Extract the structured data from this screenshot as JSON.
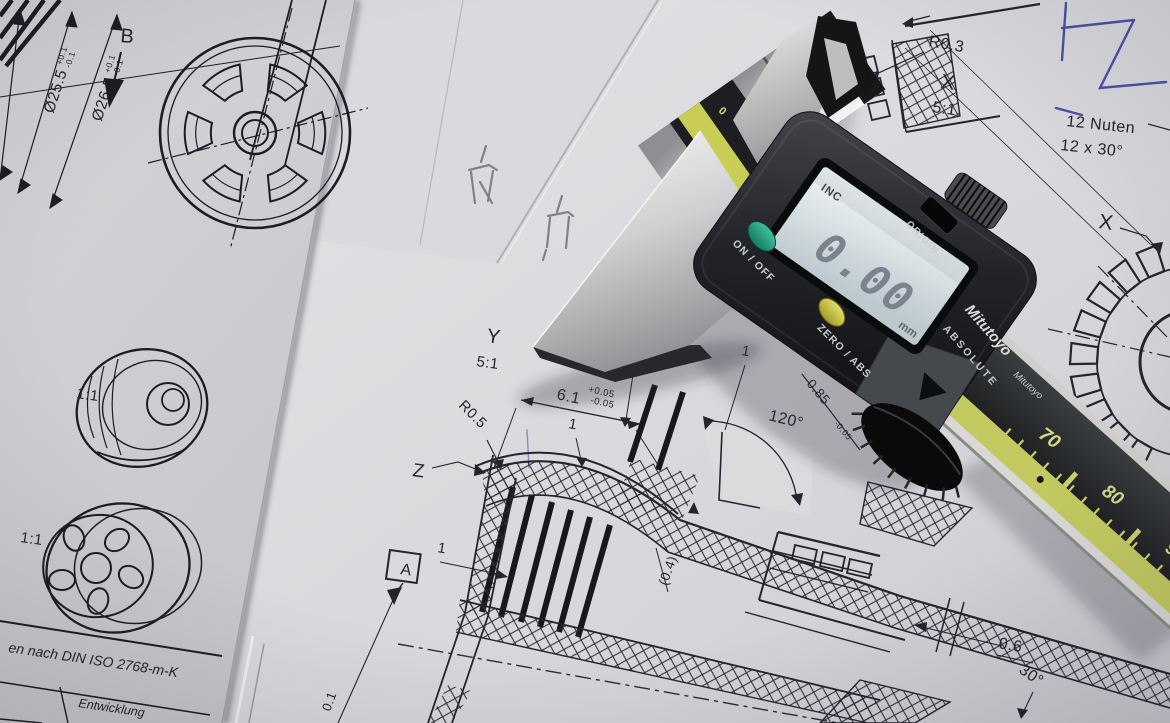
{
  "left_sheet": {
    "dim1_value": "Ø25.5",
    "dim1_tol_plus": "+0.1",
    "dim1_tol_minus": "-0.1",
    "dim2_value": "Ø26.5",
    "dim2_tol_plus": "+0.1",
    "dim2_tol_minus": "-0.1",
    "section_label": "B",
    "scale_label_top": "1:1",
    "scale_label_bottom": "1:1",
    "title_block_row1": "en nach DIN ISO 2768-m-K",
    "title_block_row2": "Entwicklung"
  },
  "right_sheet": {
    "radius_label_top": "R0.3",
    "detail_x_top": {
      "label": "X",
      "scale": "5:1"
    },
    "note_line1": "12 Nuten",
    "note_line2": "12 x 30°",
    "detail_x_side": "X",
    "detail_y": {
      "label": "Y",
      "scale": "5:1"
    },
    "width_dim": {
      "value": "6.1",
      "tol_plus": "+0.05",
      "tol_minus": "-0.05"
    },
    "radius_label_mid": "R0.5",
    "detail_z": "Z",
    "dim_one_top": "1",
    "dim_one_mid": "1",
    "dim_one_left": "1",
    "dim_one_right": "1",
    "angle_dim": "120°",
    "groove_dim": {
      "value": "0.85",
      "tol_minus": "-0.05"
    },
    "ref_dim": "(0.4)",
    "datum_label": "A",
    "edge_dim": "0.1",
    "depth_dim": "0.6",
    "chamfer_dim": "30°"
  },
  "caliper": {
    "brand": "Mitutoyo",
    "series": "ABSOLUTE",
    "lcd": {
      "mode": "INC",
      "value": "0.00",
      "unit": "mm"
    },
    "buttons": {
      "power": "ON / OFF",
      "zero": "ZERO / ABS",
      "origin": "ORIGIN"
    },
    "scale": {
      "n70": "70",
      "n80": "80",
      "n90": "90",
      "zero_mark": "0"
    }
  },
  "colors": {
    "paper": "#dfdfe2",
    "ink": "#23242c",
    "pen_blue": "#4a50a8",
    "pencil": "#80808a",
    "beam_scale": "#c3c960",
    "button_green": "#2ea888",
    "button_yellow": "#d9d24e",
    "lcd_glass": "#dfe8ea"
  }
}
